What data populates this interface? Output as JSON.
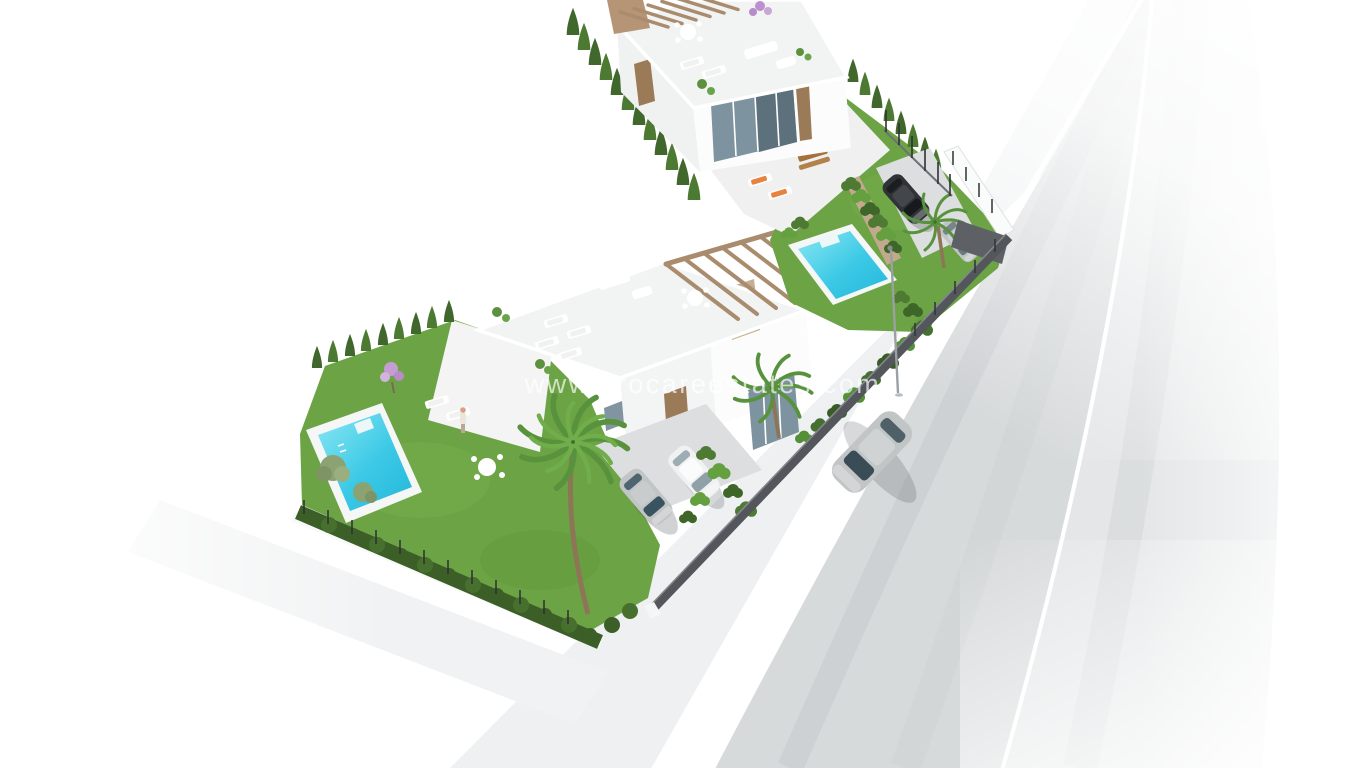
{
  "image": {
    "type": "3d-architectural-render",
    "description": "Aerial 3D render of a new-build development: two modern white villas on an L-shaped plot, each with private pool, lawn, palm trees, cypress hedges and parked cars, beside a curving asphalt road with a driving car"
  },
  "watermark": {
    "text": "www.procareestates.com"
  },
  "scene": {
    "villas": 2,
    "pools": 2,
    "parked_cars": 4,
    "moving_cars": 1,
    "street_lamps": 1
  },
  "colors": {
    "background": "#ffffff",
    "grass": "#6ca344",
    "grass_light": "#7cb251",
    "cypress": "#41682c",
    "cypress_alt": "#4d7a33",
    "hedge": "#3c5e27",
    "bush_green": "#4e7a33",
    "bush_light": "#64a03f",
    "pool_water": "#3cc9e6",
    "pool_water_light": "#8ae7f3",
    "pool_water_deep": "#24b7da",
    "pool_deck": "#f5f7f7",
    "road_sidewalk": "#eef0f1",
    "road_lane": "#d7dadb",
    "road_shoulder": "#e4e6e7",
    "road_line": "#ffffff",
    "wall_dark": "#53575b",
    "gate_dark": "#5d6165",
    "planter_tan": "#c2a98c",
    "pergola_wood": "#a98c6d",
    "pergola_slab": "#b59576",
    "house_white": "#fcfcfc",
    "house_roof": "#f2f3f3",
    "glass": "#7e93a0",
    "wood_door": "#9b7a57",
    "cushion_orange": "#e8833f",
    "car_black": "#2f3336",
    "car_silver": "#c2c5c6",
    "car_white": "#f0f1f1",
    "palm_green": "#58923d",
    "olive_green": "#8ba272",
    "blossom_purple": "#c49ed3",
    "trunk_brown": "#8d7657"
  }
}
